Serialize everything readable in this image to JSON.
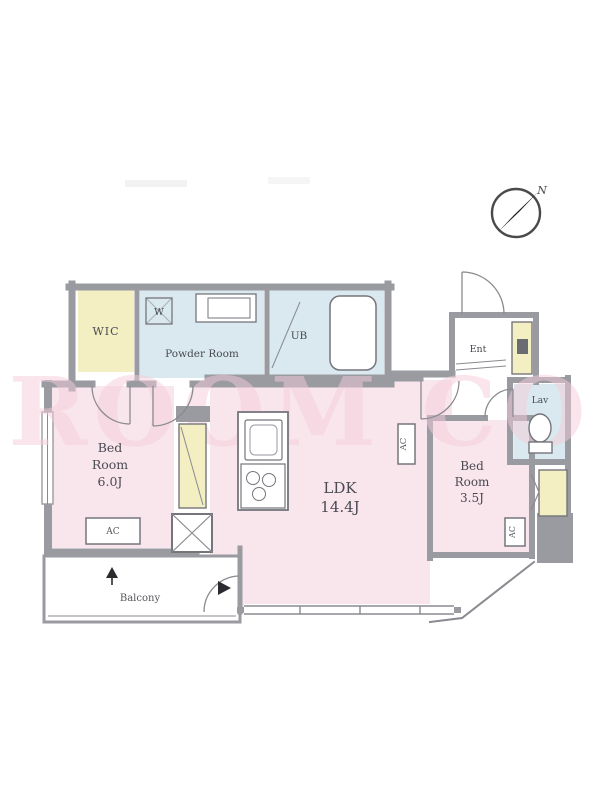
{
  "title": "apartment-floor-plan",
  "watermark": "ROOM CO",
  "compass": {
    "north_label": "N"
  },
  "rooms": {
    "wic": {
      "label": "WIC"
    },
    "powder_room": {
      "label": "Powder Room"
    },
    "washer": {
      "label": "W"
    },
    "bath": {
      "label": "UB"
    },
    "entrance": {
      "label": "Ent"
    },
    "lavatory": {
      "label": "Lav"
    },
    "bedroom1": {
      "line1": "Bed",
      "line2": "Room",
      "size": "6.0J"
    },
    "ldk": {
      "name": "LDK",
      "size": "14.4J"
    },
    "bedroom2": {
      "line1": "Bed",
      "line2": "Room",
      "size": "3.5J"
    },
    "balcony": {
      "label": "Balcony"
    },
    "ac": {
      "label": "AC"
    }
  },
  "colors": {
    "wall": "#9a9aa1",
    "wall_dark": "#75757c",
    "room_pink": "#f9e6ec",
    "room_blue": "#d9e9ef",
    "room_yellow": "#f3efc3",
    "text": "#4a4a52",
    "watermark_pink": "#f5cdd9"
  }
}
